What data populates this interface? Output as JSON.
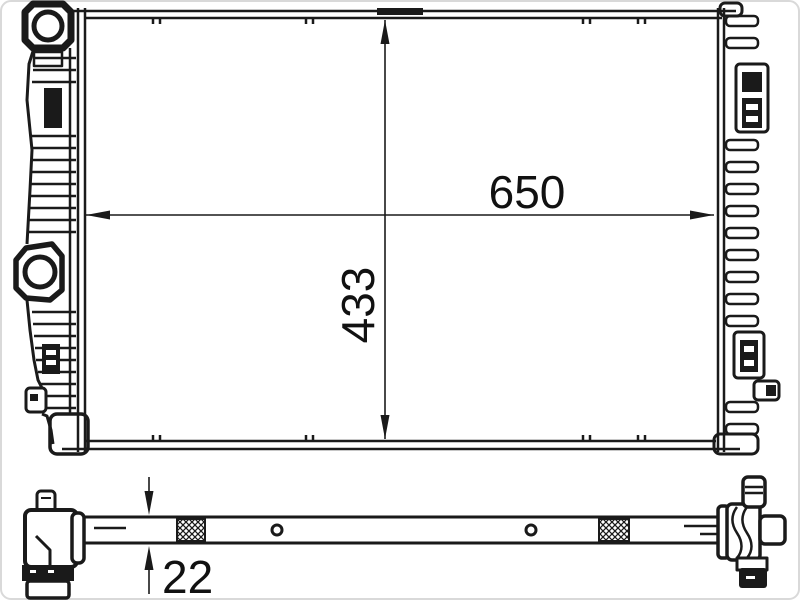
{
  "drawing": {
    "front_view": {
      "width_dimension": "650",
      "height_dimension": "433"
    },
    "bottom_view": {
      "thickness_dimension": "22"
    },
    "colors": {
      "line": "#1a1a1a",
      "background": "#ffffff",
      "frame": "#d9d9d9"
    }
  }
}
